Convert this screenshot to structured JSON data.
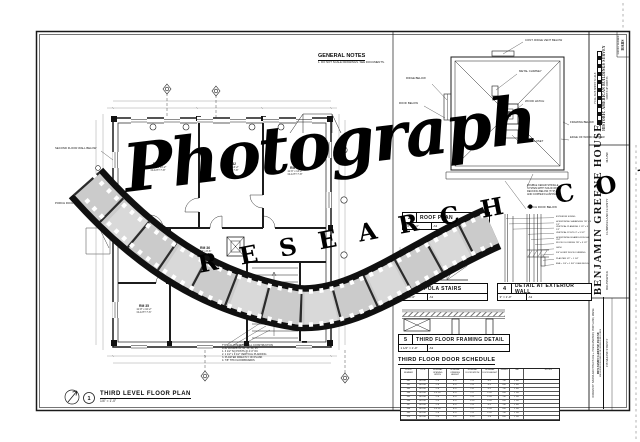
{
  "watermark": {
    "script_text": "Photograph",
    "spaced_text": "R E S E A R C H . C O M"
  },
  "general_notes": {
    "title": "GENERAL NOTES",
    "note": "1. DO NOT SCALE DRAWINGS. SEE DOCUMENTS."
  },
  "floor_plan": {
    "number": "1",
    "title": "THIRD LEVEL FLOOR PLAN",
    "scale": "1/4\" = 1'-0\"",
    "rooms": [
      {
        "name": "RM 31",
        "dims": "11'-10\" x 13'-2\"",
        "clg": "CLG HT 7'-8\""
      },
      {
        "name": "RM 32",
        "dims": "12'-4\" x 13'-2\"",
        "clg": "CLG HT 7'-8\""
      },
      {
        "name": "RM 33",
        "dims": "11'-6\" x 13'-2\"",
        "clg": "CLG HT 7'-8\""
      },
      {
        "name": "RM 34",
        "dims": "11'-8\" x 9'-6\"",
        "clg": "CLG HT 7'-6\""
      },
      {
        "name": "RM 35",
        "dims": "11'-8\" x 10'-2\"",
        "clg": "CLG HT 7'-6\""
      },
      {
        "name": "RM 36",
        "dims": "9'-4\" x 8'-6\"",
        "clg": "CLG HT 7'-6\""
      }
    ],
    "left_note_1": "SECOND FLOOR WALL BELOW",
    "left_note_2": "PORCH ROOF RIDGE BELOW",
    "bottom_note": [
      "TYPICAL INTERIOR WALL CONSTRUCTION",
      "FOR ROOMS 31, 32, 33, 34, 35:",
      "1. 3 1/2\" SQ POSTS @ 4'-0\" OC",
      "2. 1 1/2\" x 9 1/2\" VERTICAL PLANKING",
      "3. PLASTER DIRECTLY ON PLANK",
      "4. 7/8\" THK FLOORBOARDS"
    ]
  },
  "roof_plan": {
    "number": "2",
    "title": "ROOF PLAN",
    "scale": "1/4\" = 1'-0\"",
    "ref": "A3",
    "labels": {
      "ridge_vent": "CONT. RIDGE VENT BELOW",
      "chimney": "METAL CHIMNEY",
      "hatch": "WOOD HATCH",
      "ladder": "LADDER CLOSET",
      "framing": "FRAMING BELOW",
      "gutter": "EDGE OF WOOD GUTTER",
      "shingles": [
        "DOUBLE CEDAR SHINGLE",
        "SYSTEM WITH SOLID WOOD",
        "DECKING BELOW (TYP)",
        "AND COPPER FLASHING"
      ],
      "porch": "PORCH ROOF BELOW",
      "left_1": "RIDGE BELOW",
      "left_2": "ROOF BELOW"
    }
  },
  "cupola_stairs": {
    "number": "3",
    "title": "CUPOLA STAIRS",
    "scale": "1/2\" = 1'-0\"",
    "ref": "A3"
  },
  "wall_detail": {
    "number": "4",
    "title": "DETAIL AT EXTERIOR WALL",
    "scale": "3\" = 1'-0\"",
    "ref": "A3",
    "labels": [
      "EXTERIOR SIDING",
      "HORIZONTAL SHEATHING 7/8\" x 9 1/2\"",
      "VERTICAL PLANKING 1 1/2\" x 9 1/2\"",
      "VERTICAL POSTS 3\" x 3 1/2\"",
      "HORIZONTAL BOARDS ROUGH CUT",
      "WOOD FLOORING 7/8\" x 3 1/2\"",
      "LATH",
      "3/4\" HORIZ WOOD FURRING",
      "PLASTER 1/2\" + 1 1/4\"",
      "BSB + 1/4\" x 1 3/4\" OGEE MLDG"
    ]
  },
  "framing_detail": {
    "number": "5",
    "title": "THIRD FLOOR FRAMING DETAIL",
    "scale": "1 1/2\" = 1'-0\"",
    "ref": "A3"
  },
  "door_schedule": {
    "title": "THIRD FLOOR DOOR SCHEDULE",
    "columns": [
      "DOOR NUMBER",
      "TYPE",
      "NOMINAL OPENING WIDTH",
      "NOMINAL OPENING HEIGHT",
      "NOMINAL DOOR WIDTH",
      "NOMINAL DOOR HEIGHT",
      "SWING",
      "THK",
      "NOTES"
    ],
    "rows": [
      [
        "301",
        "WOOD",
        "2'-6\"",
        "6'-4\"",
        "2'-4\"",
        "6'-2\"",
        "LH",
        "1 3/8\"",
        ""
      ],
      [
        "302",
        "WOOD",
        "2'-6\"",
        "6'-4\"",
        "2'-4\"",
        "6'-2\"",
        "RH",
        "1 3/8\"",
        ""
      ],
      [
        "303",
        "WOOD",
        "2'-8\"",
        "6'-4\"",
        "2'-6\"",
        "6'-2\"",
        "LH",
        "1 3/8\"",
        ""
      ],
      [
        "304",
        "WOOD",
        "2'-4 1/2\"",
        "6'-0\"",
        "2'-2\"",
        "5'-10\"",
        "RH",
        "1 1/8\"",
        ""
      ],
      [
        "305",
        "WOOD",
        "2'-6\"",
        "6'-0\"",
        "2'-4\"",
        "5'-10\"",
        "LH",
        "1 1/8\"",
        ""
      ],
      [
        "306",
        "WOOD",
        "2'-0\"",
        "6'-0\"",
        "1'-10\"",
        "5'-10\"",
        "RH",
        "1 1/8\"",
        ""
      ],
      [
        "307",
        "WOOD",
        "2'-6\"",
        "6'-4\"",
        "2'-4\"",
        "6'-2\"",
        "LH",
        "1 3/8\"",
        ""
      ],
      [
        "308",
        "WOOD",
        "2'-4 1/2\"",
        "6'-0\"",
        "2'-2\"",
        "5'-10\"",
        "RH",
        "1 1/8\"",
        ""
      ],
      [
        "309",
        "WOOD",
        "2'-6\"",
        "6'-0\"",
        "2'-4\"",
        "5'-10\"",
        "LH",
        "1 1/8\"",
        ""
      ],
      [
        "310",
        "WOOD",
        "2'-0\"",
        "5'-8\"",
        "1'-10\"",
        "5'-6\"",
        "RH",
        "1 1/8\"",
        ""
      ]
    ]
  },
  "title_block": {
    "survey_label": "SURVEY NUMBER",
    "survey_value": "HABS",
    "scale_caption": "FULL SIZE SHEET SCALE",
    "org_line": "HISTORIC AMERICAN BUILDINGS SURVEY",
    "sheet_line": "SHEET OF SHEETS",
    "house_title": "BENJAMIN GREENE HOUSE",
    "city": "BRUNSWICK",
    "county": "CUMBERLAND COUNTY",
    "state": "MAINE",
    "credit_line": "DRAWN BY: BARBA ARCHITECTURE + PRESERVATION, PORTLAND, MAINE",
    "credit_sub1": "BENJAMIN GREENE HOUSE",
    "credit_sub2": "MEASURED DRAWINGS FROM FIELD RECORDS",
    "address": "158 MAINE STREET"
  }
}
